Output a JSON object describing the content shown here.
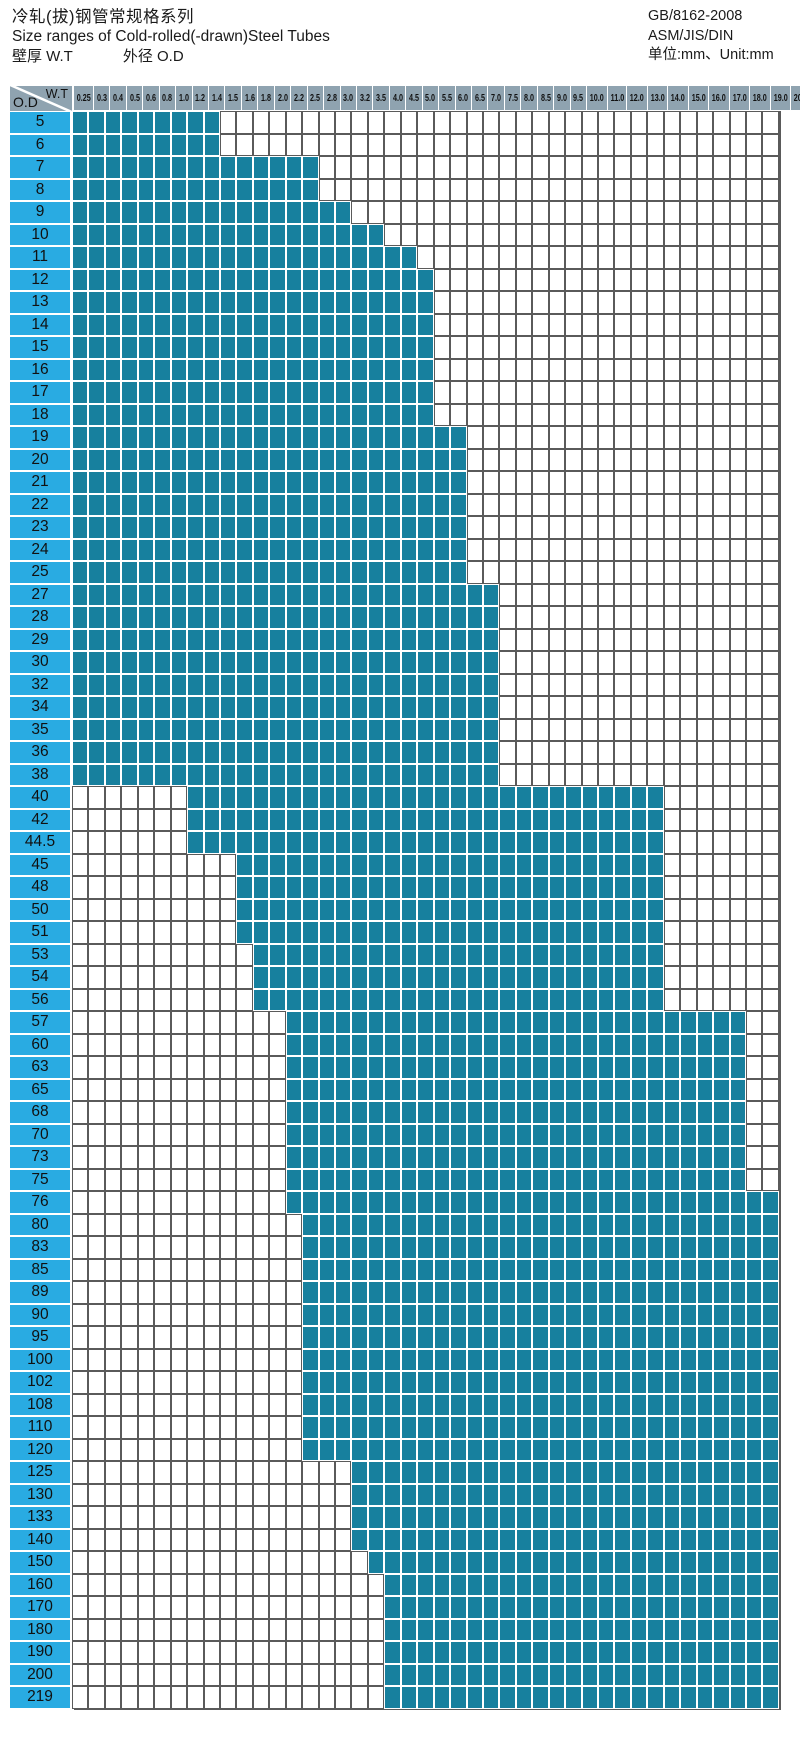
{
  "header": {
    "title_zh": "冷轧(拔)钢管常规格系列",
    "title_en": "Size ranges of Cold-rolled(-drawn)Steel Tubes",
    "legend_wt": "壁厚  W.T",
    "legend_od": "外径  O.D",
    "standard_1": "GB/8162-2008",
    "standard_2": "ASM/JIS/DIN",
    "unit": "单位:mm、Unit:mm"
  },
  "matrix": {
    "corner_top": "W.T",
    "corner_bottom": "O.D"
  },
  "colors": {
    "fill": "#17809E",
    "od_label_bg": "#29ABE2",
    "header_bg": "#8FA3B0",
    "grid_line": "#5A5A5A"
  },
  "chart_data": {
    "type": "heatmap",
    "title": "冷轧(拔)钢管常规格系列 / Size ranges of Cold-rolled(-drawn)Steel Tubes",
    "xlabel": "W.T",
    "ylabel": "O.D",
    "unit": "mm",
    "wt_columns": [
      "0.25",
      "0.3",
      "0.4",
      "0.5",
      "0.6",
      "0.8",
      "1.0",
      "1.2",
      "1.4",
      "1.5",
      "1.6",
      "1.8",
      "2.0",
      "2.2",
      "2.5",
      "2.8",
      "3.0",
      "3.2",
      "3.5",
      "4.0",
      "4.5",
      "5.0",
      "5.5",
      "6.0",
      "6.5",
      "7.0",
      "7.5",
      "8.0",
      "8.5",
      "9.0",
      "9.5",
      "10.0",
      "11.0",
      "12.0",
      "13.0",
      "14.0",
      "15.0",
      "16.0",
      "17.0",
      "18.0",
      "19.0",
      "20.0",
      "21.0"
    ],
    "rows": [
      {
        "od": "5",
        "wt_from": "0.25",
        "wt_to": "1.4"
      },
      {
        "od": "6",
        "wt_from": "0.25",
        "wt_to": "1.4"
      },
      {
        "od": "7",
        "wt_from": "0.25",
        "wt_to": "2.5"
      },
      {
        "od": "8",
        "wt_from": "0.25",
        "wt_to": "2.5"
      },
      {
        "od": "9",
        "wt_from": "0.25",
        "wt_to": "3.0"
      },
      {
        "od": "10",
        "wt_from": "0.25",
        "wt_to": "3.5"
      },
      {
        "od": "11",
        "wt_from": "0.25",
        "wt_to": "4.5"
      },
      {
        "od": "12",
        "wt_from": "0.25",
        "wt_to": "5.0"
      },
      {
        "od": "13",
        "wt_from": "0.25",
        "wt_to": "5.0"
      },
      {
        "od": "14",
        "wt_from": "0.25",
        "wt_to": "5.0"
      },
      {
        "od": "15",
        "wt_from": "0.25",
        "wt_to": "5.0"
      },
      {
        "od": "16",
        "wt_from": "0.25",
        "wt_to": "5.0"
      },
      {
        "od": "17",
        "wt_from": "0.25",
        "wt_to": "5.0"
      },
      {
        "od": "18",
        "wt_from": "0.25",
        "wt_to": "5.0"
      },
      {
        "od": "19",
        "wt_from": "0.25",
        "wt_to": "6.0"
      },
      {
        "od": "20",
        "wt_from": "0.25",
        "wt_to": "6.0"
      },
      {
        "od": "21",
        "wt_from": "0.25",
        "wt_to": "6.0"
      },
      {
        "od": "22",
        "wt_from": "0.25",
        "wt_to": "6.0"
      },
      {
        "od": "23",
        "wt_from": "0.25",
        "wt_to": "6.0"
      },
      {
        "od": "24",
        "wt_from": "0.25",
        "wt_to": "6.0"
      },
      {
        "od": "25",
        "wt_from": "0.25",
        "wt_to": "6.0"
      },
      {
        "od": "27",
        "wt_from": "0.25",
        "wt_to": "7.0"
      },
      {
        "od": "28",
        "wt_from": "0.25",
        "wt_to": "7.0"
      },
      {
        "od": "29",
        "wt_from": "0.25",
        "wt_to": "7.0"
      },
      {
        "od": "30",
        "wt_from": "0.25",
        "wt_to": "7.0"
      },
      {
        "od": "32",
        "wt_from": "0.25",
        "wt_to": "7.0"
      },
      {
        "od": "34",
        "wt_from": "0.25",
        "wt_to": "7.0"
      },
      {
        "od": "35",
        "wt_from": "0.25",
        "wt_to": "7.0"
      },
      {
        "od": "36",
        "wt_from": "0.25",
        "wt_to": "7.0"
      },
      {
        "od": "38",
        "wt_from": "0.25",
        "wt_to": "7.0"
      },
      {
        "od": "40",
        "wt_from": "1.2",
        "wt_to": "14.0"
      },
      {
        "od": "42",
        "wt_from": "1.2",
        "wt_to": "14.0"
      },
      {
        "od": "44.5",
        "wt_from": "1.2",
        "wt_to": "14.0"
      },
      {
        "od": "45",
        "wt_from": "1.6",
        "wt_to": "14.0"
      },
      {
        "od": "48",
        "wt_from": "1.6",
        "wt_to": "14.0"
      },
      {
        "od": "50",
        "wt_from": "1.6",
        "wt_to": "14.0"
      },
      {
        "od": "51",
        "wt_from": "1.6",
        "wt_to": "14.0"
      },
      {
        "od": "53",
        "wt_from": "1.8",
        "wt_to": "14.0"
      },
      {
        "od": "54",
        "wt_from": "1.8",
        "wt_to": "14.0"
      },
      {
        "od": "56",
        "wt_from": "1.8",
        "wt_to": "14.0"
      },
      {
        "od": "57",
        "wt_from": "2.2",
        "wt_to": "19.0"
      },
      {
        "od": "60",
        "wt_from": "2.2",
        "wt_to": "19.0"
      },
      {
        "od": "63",
        "wt_from": "2.2",
        "wt_to": "19.0"
      },
      {
        "od": "65",
        "wt_from": "2.2",
        "wt_to": "19.0"
      },
      {
        "od": "68",
        "wt_from": "2.2",
        "wt_to": "19.0"
      },
      {
        "od": "70",
        "wt_from": "2.2",
        "wt_to": "19.0"
      },
      {
        "od": "73",
        "wt_from": "2.2",
        "wt_to": "19.0"
      },
      {
        "od": "75",
        "wt_from": "2.2",
        "wt_to": "19.0"
      },
      {
        "od": "76",
        "wt_from": "2.2",
        "wt_to": "21.0"
      },
      {
        "od": "80",
        "wt_from": "2.5",
        "wt_to": "21.0"
      },
      {
        "od": "83",
        "wt_from": "2.5",
        "wt_to": "21.0"
      },
      {
        "od": "85",
        "wt_from": "2.5",
        "wt_to": "21.0"
      },
      {
        "od": "89",
        "wt_from": "2.5",
        "wt_to": "21.0"
      },
      {
        "od": "90",
        "wt_from": "2.5",
        "wt_to": "21.0"
      },
      {
        "od": "95",
        "wt_from": "2.5",
        "wt_to": "21.0"
      },
      {
        "od": "100",
        "wt_from": "2.5",
        "wt_to": "21.0"
      },
      {
        "od": "102",
        "wt_from": "2.5",
        "wt_to": "21.0"
      },
      {
        "od": "108",
        "wt_from": "2.5",
        "wt_to": "21.0"
      },
      {
        "od": "110",
        "wt_from": "2.5",
        "wt_to": "21.0"
      },
      {
        "od": "120",
        "wt_from": "2.5",
        "wt_to": "21.0"
      },
      {
        "od": "125",
        "wt_from": "3.2",
        "wt_to": "21.0"
      },
      {
        "od": "130",
        "wt_from": "3.2",
        "wt_to": "21.0"
      },
      {
        "od": "133",
        "wt_from": "3.2",
        "wt_to": "21.0"
      },
      {
        "od": "140",
        "wt_from": "3.2",
        "wt_to": "21.0"
      },
      {
        "od": "150",
        "wt_from": "3.5",
        "wt_to": "21.0"
      },
      {
        "od": "160",
        "wt_from": "4.0",
        "wt_to": "21.0"
      },
      {
        "od": "170",
        "wt_from": "4.0",
        "wt_to": "21.0"
      },
      {
        "od": "180",
        "wt_from": "4.0",
        "wt_to": "21.0"
      },
      {
        "od": "190",
        "wt_from": "4.0",
        "wt_to": "21.0"
      },
      {
        "od": "200",
        "wt_from": "4.0",
        "wt_to": "21.0"
      },
      {
        "od": "219",
        "wt_from": "4.0",
        "wt_to": "21.0"
      }
    ]
  }
}
